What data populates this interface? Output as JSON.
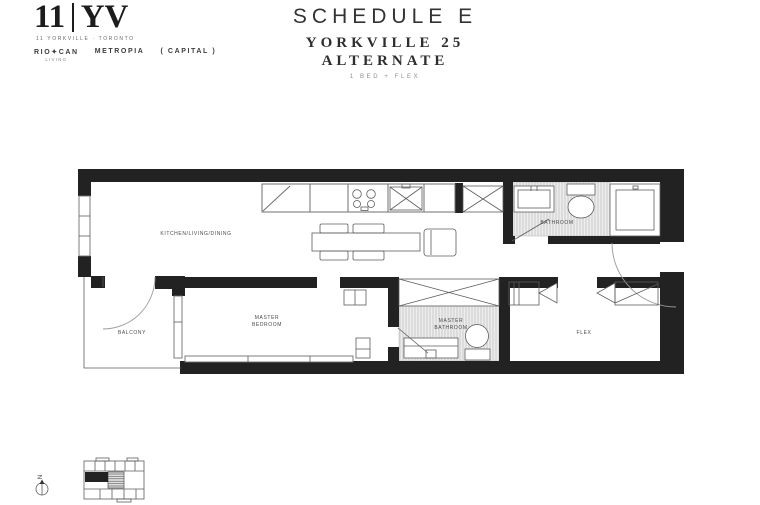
{
  "colors": {
    "wall": "#222222",
    "line": "#6f6f6f",
    "label": "#4a4a4a",
    "ink": "#1c1c1c",
    "muted": "#8d8d8d",
    "hatch-bg": "#ededed",
    "hatch-line": "#c9c9c9"
  },
  "logo": {
    "number": "11",
    "letters": "YV",
    "tagline": "11 YORKVILLE · TORONTO",
    "partners": [
      {
        "name": "RIO✦CAN",
        "sub": "LIVING"
      },
      {
        "name": "METROPIA"
      },
      {
        "name": "( CAPITAL )"
      }
    ]
  },
  "title": {
    "schedule": "SCHEDULE E",
    "project": "YORKVILLE 25",
    "variant": "ALTERNATE",
    "unit_type": "1 BED + FLEX"
  },
  "floorplan": {
    "rooms": {
      "kitchen_living_dining": "KITCHEN/LIVING/DINING",
      "master_bedroom_line1": "MASTER",
      "master_bedroom_line2": "BEDROOM",
      "master_bathroom_line1": "MASTER",
      "master_bathroom_line2": "BATHROOM",
      "bathroom": "BATHROOM",
      "balcony": "BALCONY",
      "flex": "FLEX"
    }
  },
  "keyplan": {
    "north_label": "N"
  }
}
